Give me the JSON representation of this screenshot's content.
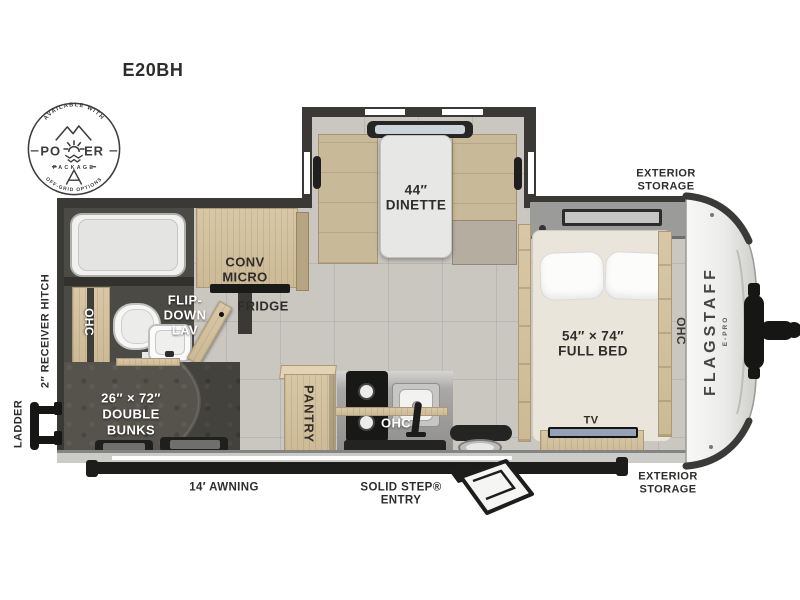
{
  "title": "E20BH",
  "badge": {
    "available": "AVAILABLE WITH",
    "power_left": "PO",
    "power_right": "ER",
    "package": "PACKAGE",
    "offgrid": "OFF-GRID OPTIONS"
  },
  "brand": {
    "name": "FLAGSTAFF",
    "sub": "E-PRO"
  },
  "rooms": {
    "dinette_size": "44″",
    "dinette": "DINETTE",
    "bed_size": "54″ × 74″",
    "bed": "FULL BED",
    "bunks_size": "26″ × 72″",
    "bunks_line2": "DOUBLE",
    "bunks_line3": "BUNKS",
    "conv": "CONV",
    "micro": "MICRO",
    "fridge": "FRIDGE",
    "lav_line1": "FLIP-",
    "lav_line2": "DOWN",
    "lav_line3": "LAV",
    "pantry": "PANTRY",
    "ohc": "OHC",
    "tv": "TV"
  },
  "exterior": {
    "storage_line1": "EXTERIOR",
    "storage_line2": "STORAGE",
    "hitch": "2″ RECEIVER HITCH",
    "ladder": "LADDER",
    "awning": "14′ AWNING",
    "entry_line1": "SOLID STEP®",
    "entry_line2": "ENTRY"
  },
  "colors": {
    "wall": "#3a3936",
    "wood": "#d3c2a1",
    "floor_tile": "#cac7c1",
    "dark_room": "#56534c",
    "accent_black": "#1c1c1c"
  }
}
